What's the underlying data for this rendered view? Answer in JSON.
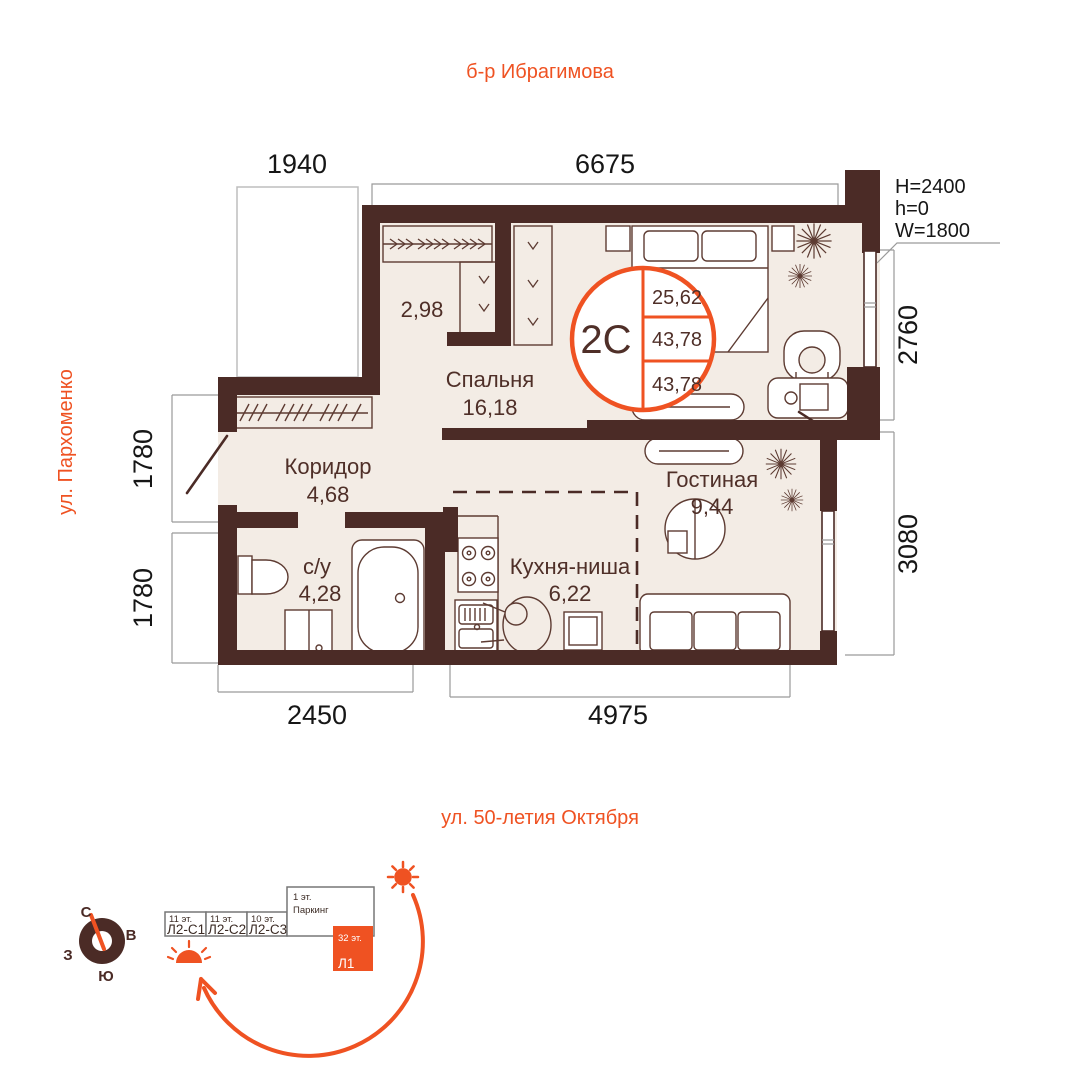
{
  "plan": {
    "streets": {
      "top": "б-р Ибрагимова",
      "left": "ул. Пархоменко",
      "bottom": "ул. 50-летия Октября"
    },
    "dims": {
      "d1940": "1940",
      "d6675": "6675",
      "d2760": "2760",
      "d3080": "3080",
      "d1780_upper": "1780",
      "d1780_lower": "1780",
      "d2450": "2450",
      "d4975": "4975"
    },
    "window_spec": {
      "h_big": "H=2400",
      "h_small": "h=0",
      "w": "W=1800"
    },
    "badge": {
      "type": "2С",
      "rows": [
        "25,62",
        "43,78",
        "43,78"
      ]
    },
    "rooms": {
      "closet": {
        "area": "2,98"
      },
      "bedroom": {
        "name": "Спальня",
        "area": "16,18"
      },
      "corridor": {
        "name": "Коридор",
        "area": "4,68"
      },
      "bathroom": {
        "name": "с/у",
        "area": "4,28"
      },
      "kitchen": {
        "name": "Кухня-ниша",
        "area": "6,22"
      },
      "living": {
        "name": "Гостиная",
        "area": "9,44"
      }
    }
  },
  "site": {
    "compass": {
      "n": "С",
      "e": "В",
      "s": "Ю",
      "w": "З"
    },
    "blocks": [
      {
        "floors": "11 эт.",
        "name": "Л2-С1"
      },
      {
        "floors": "11 эт.",
        "name": "Л2-С2"
      },
      {
        "floors": "10 эт.",
        "name": "Л2-С3"
      },
      {
        "floors": "1 эт.",
        "name": "Паркинг"
      },
      {
        "floors": "32 эт.",
        "name": "Л1"
      }
    ]
  },
  "colors": {
    "accent": "#ef5222",
    "wall": "#4b2b26",
    "floor": "#f3ece5"
  }
}
